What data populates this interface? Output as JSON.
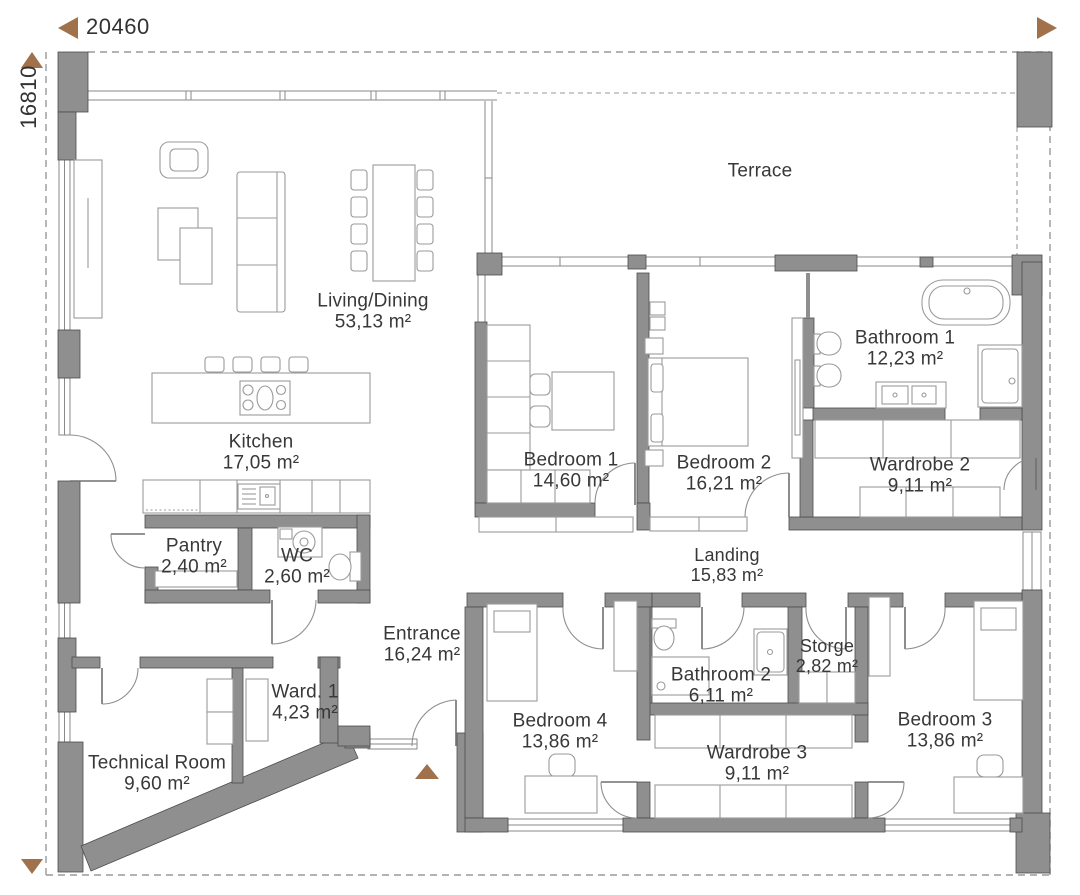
{
  "dimensions": {
    "width": "20460",
    "height": "16810"
  },
  "rooms": {
    "living": {
      "name": "Living/Dining",
      "area": "53,13 m²"
    },
    "kitchen": {
      "name": "Kitchen",
      "area": "17,05 m²"
    },
    "pantry": {
      "name": "Pantry",
      "area": "2,40 m²"
    },
    "wc": {
      "name": "WC",
      "area": "2,60 m²"
    },
    "entrance": {
      "name": "Entrance",
      "area": "16,24 m²"
    },
    "ward1": {
      "name": "Ward. 1",
      "area": "4,23 m²"
    },
    "technical": {
      "name": "Technical Room",
      "area": "9,60 m²"
    },
    "terrace": {
      "name": "Terrace"
    },
    "bedroom1": {
      "name": "Bedroom 1",
      "area": "14,60 m²"
    },
    "bedroom2": {
      "name": "Bedroom 2",
      "area": "16,21 m²"
    },
    "bathroom1": {
      "name": "Bathroom 1",
      "area": "12,23 m²"
    },
    "wardrobe2": {
      "name": "Wardrobe 2",
      "area": "9,11 m²"
    },
    "landing": {
      "name": "Landing",
      "area": "15,83 m²"
    },
    "bathroom2": {
      "name": "Bathroom 2",
      "area": "6,11 m²"
    },
    "storge": {
      "name": "Storge",
      "area": "2,82 m²"
    },
    "wardrobe3": {
      "name": "Wardrobe 3",
      "area": "9,11 m²"
    },
    "bedroom3": {
      "name": "Bedroom 3",
      "area": "13,86 m²"
    },
    "bedroom4": {
      "name": "Bedroom 4",
      "area": "13,86 m²"
    }
  },
  "colors": {
    "wall": "#8f8f8f",
    "wall_edge": "#4c4c4c",
    "accent": "#a0714a",
    "line": "#9a9a9a",
    "text": "#383838"
  }
}
